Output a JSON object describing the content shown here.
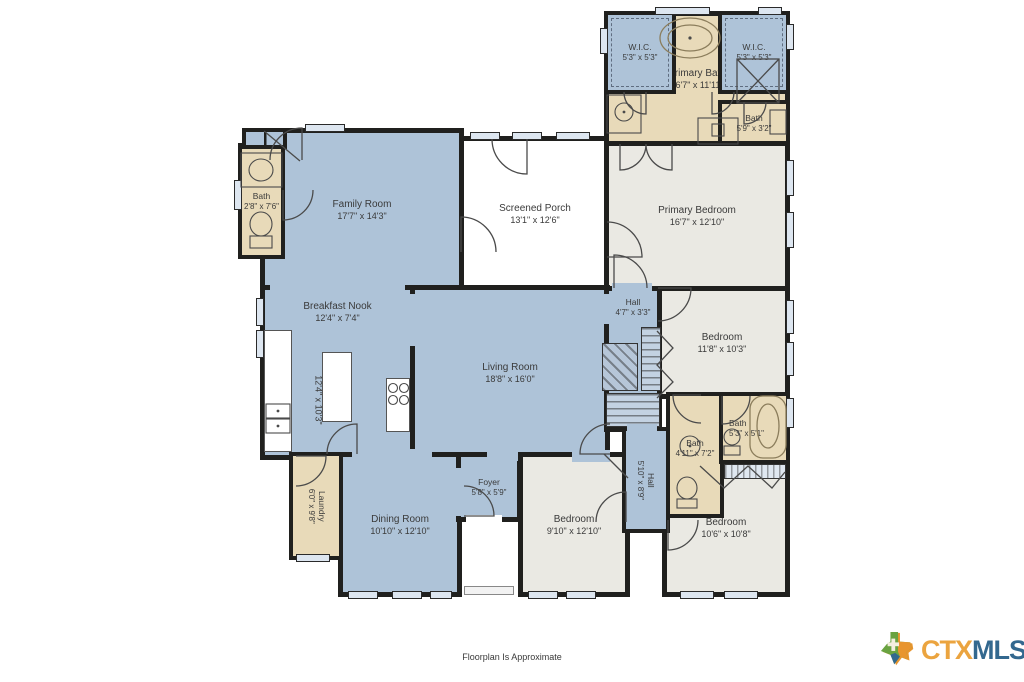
{
  "rooms": {
    "family": {
      "name": "Family Room",
      "dims": "17'7\" x 14'3\""
    },
    "porch": {
      "name": "Screened Porch",
      "dims": "13'1\" x 12'6\""
    },
    "bath1": {
      "name": "Bath",
      "dims": "2'8\" x 7'6\""
    },
    "wic_left": {
      "name": "W.I.C.",
      "dims": "5'3\" x 5'3\""
    },
    "wic_right": {
      "name": "W.I.C.",
      "dims": "5'3\" x 5'3\""
    },
    "primary_bath": {
      "name": "Primary Bath",
      "dims": "16'7\" x 11'11\""
    },
    "bath_small": {
      "name": "Bath",
      "dims": "5'9\" x 3'2\""
    },
    "primary_bedroom": {
      "name": "Primary Bedroom",
      "dims": "16'7\" x 12'10\""
    },
    "breakfast": {
      "name": "Breakfast Nook",
      "dims": "12'4\" x 7'4\""
    },
    "kitchen": {
      "name": "Kitchen",
      "dims": "12'4\" x 10'3\""
    },
    "living": {
      "name": "Living Room",
      "dims": "18'8\" x 16'0\""
    },
    "hall_upper": {
      "name": "Hall",
      "dims": "4'7\" x 3'3\""
    },
    "bedroom2": {
      "name": "Bedroom",
      "dims": "11'8\" x 10'3\""
    },
    "bath3": {
      "name": "Bath",
      "dims": "4'11\" x 7'2\""
    },
    "bath2": {
      "name": "Bath",
      "dims": "5'3\" x 5'1\""
    },
    "hall_lower": {
      "name": "Hall",
      "dims": "5'10\" x 8'9\""
    },
    "bedroom4": {
      "name": "Bedroom",
      "dims": "10'6\" x 10'8\""
    },
    "bedroom3": {
      "name": "Bedroom",
      "dims": "9'10\" x 12'10\""
    },
    "foyer": {
      "name": "Foyer",
      "dims": "5'8\" x 5'9\""
    },
    "dining": {
      "name": "Dining Room",
      "dims": "10'10\" x 12'10\""
    },
    "laundry": {
      "name": "Laundry",
      "dims": "6'0\" x 9'8\""
    }
  },
  "footer": {
    "disclaimer": "Floorplan Is Approximate"
  },
  "logo": {
    "ctx": "CTX",
    "mls": "MLS"
  },
  "palette": {
    "wall": "#20201e",
    "room_blue": "#aec3d8",
    "room_gray": "#eae9e3",
    "room_tan": "#e8dab9",
    "porch_white": "#ffffff",
    "window_fill": "#dde6f0",
    "logo_orange": "#eba43f",
    "logo_blue": "#33688f",
    "label_text": "#3a3a3a"
  }
}
